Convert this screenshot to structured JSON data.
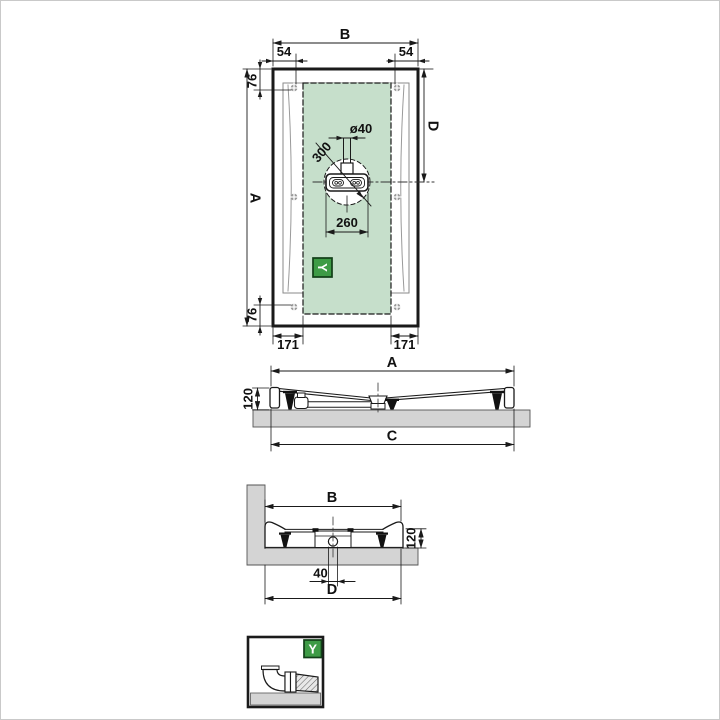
{
  "colors": {
    "highlight_green": "#c6dfcb",
    "badge_green": "#3e9b46",
    "badge_border": "#123f18",
    "floor_gray": "#d4d4d4",
    "line_black": "#1a1a1a"
  },
  "plan": {
    "b": "B",
    "side54": "54",
    "corner76": "76",
    "a": "A",
    "d": "D",
    "foot171": "171",
    "drain_dia": "ø40",
    "circle300": "300",
    "drain260": "260",
    "icon": "Y"
  },
  "front": {
    "a": "A",
    "c": "C",
    "h": "120"
  },
  "side": {
    "b": "B",
    "h": "120",
    "off": "40",
    "d": "D"
  },
  "detail": {
    "icon": "Y"
  }
}
